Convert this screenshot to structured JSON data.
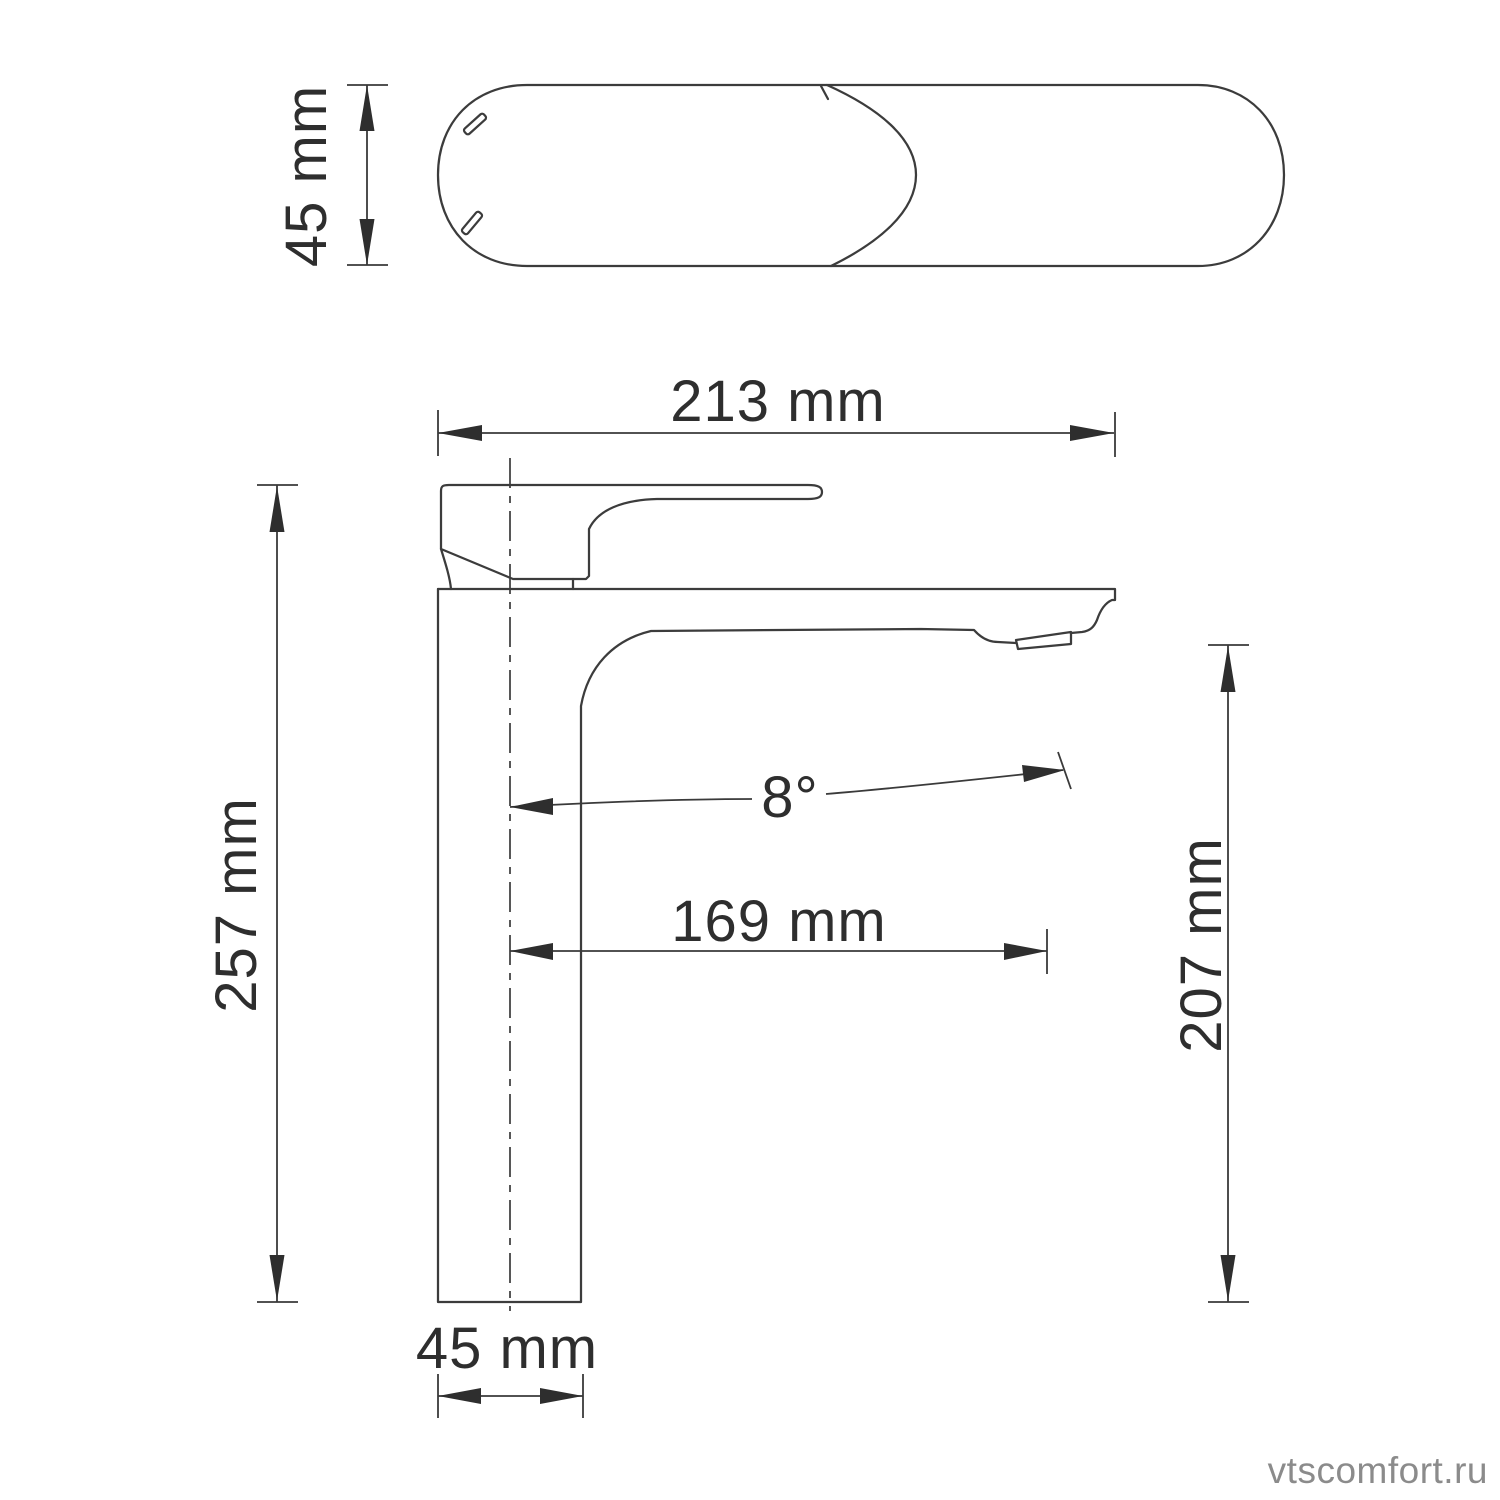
{
  "background_color": "#ffffff",
  "line_color": "#3c3c3c",
  "text_color": "#2e2e2e",
  "watermark": {
    "text": "vtscomfort.ru",
    "color": "#8b8b8b"
  },
  "top_view": {
    "depth_label": "45 mm"
  },
  "side_view": {
    "total_length_label": "213 mm",
    "total_height_label": "257 mm",
    "spout_height_label": "207 mm",
    "spout_reach_label": "169 mm",
    "spout_angle_label": "8°",
    "base_width_label": "45 mm"
  },
  "dimensions": [
    {
      "name": "body depth (top view)",
      "value": 45,
      "unit": "mm"
    },
    {
      "name": "total length",
      "value": 213,
      "unit": "mm"
    },
    {
      "name": "total height",
      "value": 257,
      "unit": "mm"
    },
    {
      "name": "spout outlet height",
      "value": 207,
      "unit": "mm"
    },
    {
      "name": "spout reach",
      "value": 169,
      "unit": "mm"
    },
    {
      "name": "spout angle",
      "value": 8,
      "unit": "deg"
    },
    {
      "name": "base width",
      "value": 45,
      "unit": "mm"
    }
  ]
}
